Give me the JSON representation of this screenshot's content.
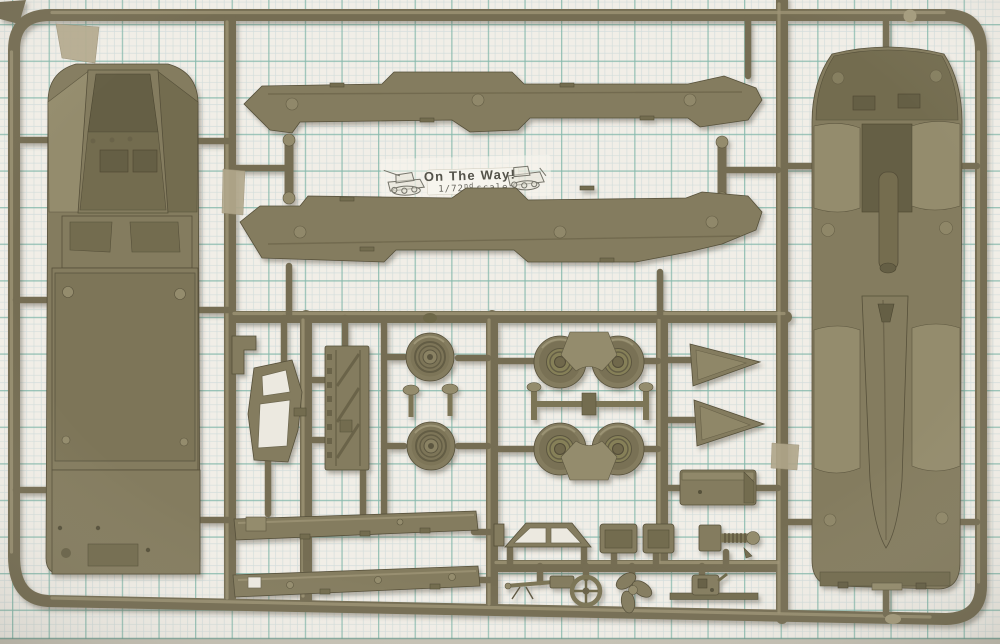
{
  "photo": {
    "subject": "olive-drab plastic model kit sprue photographed on teal graph paper",
    "label": {
      "title": "On The Way!",
      "scale_fraction": "1/72",
      "scale_superscript": "nd",
      "scale_word": "scale"
    },
    "colors": {
      "plastic": "#847c5e",
      "plastic_dark": "#6b6449",
      "plastic_light": "#a59c7d",
      "runner": "#746d52",
      "paper": "#f1eee7",
      "grid_major": "#84b8ab",
      "grid_minor": "#b9cfd2",
      "tape": "#b3a98d",
      "label_text": "#54534a"
    },
    "parts": [
      "upper-hull-body",
      "hull-side-panel-top",
      "hull-side-panel-bottom",
      "lower-hull-body",
      "road-wheel-pair",
      "road-wheel-quad",
      "axle-links",
      "fender-arches",
      "windshield-frame",
      "ladder-floor-panel",
      "triangle-bow-plate-1",
      "triangle-bow-plate-2",
      "stowage-box",
      "side-skirt-strip-1",
      "side-skirt-strip-2",
      "cab-window-frame",
      "seat-1",
      "seat-2",
      "winch-assembly",
      "machine-gun",
      "steering-wheel",
      "propeller",
      "engine-block",
      "tape-flap",
      "tape-tab"
    ]
  }
}
